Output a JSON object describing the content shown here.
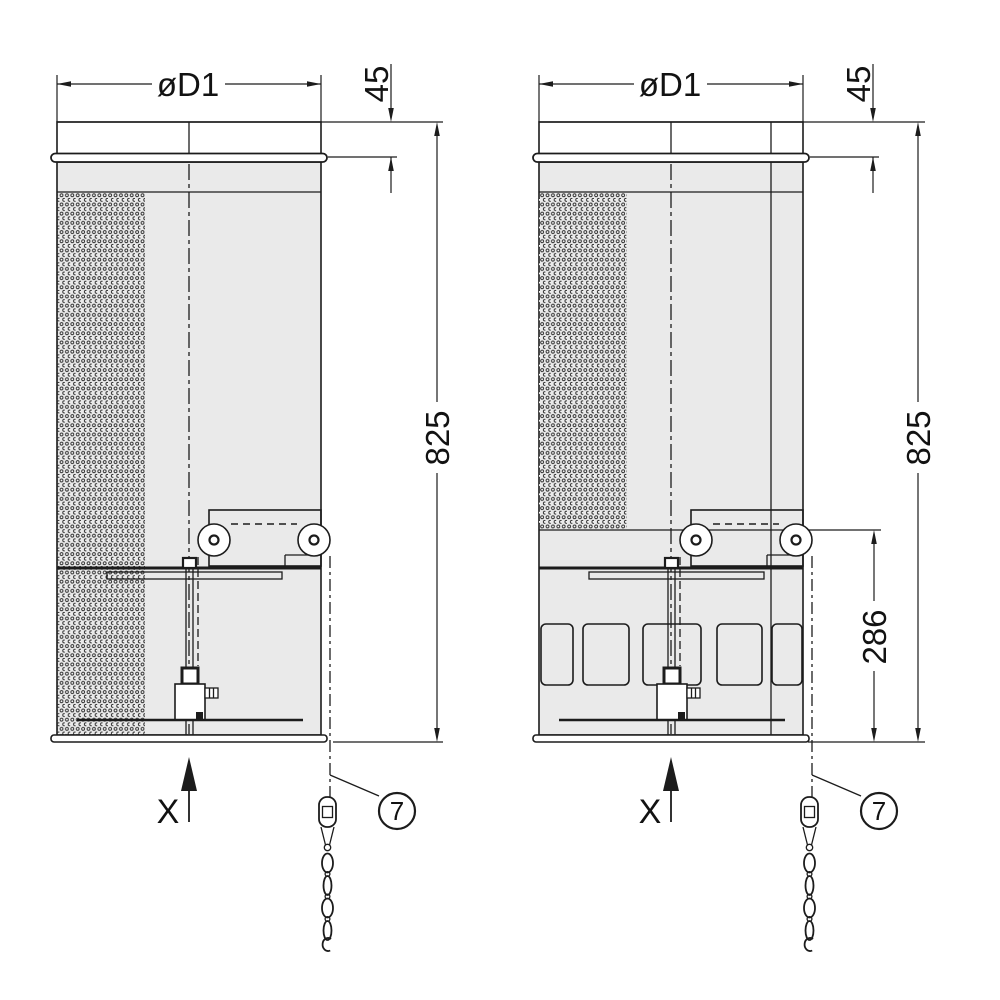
{
  "drawing": {
    "kind": "technical dimension drawing, two silencer/damper views",
    "colors": {
      "background": "#ffffff",
      "line": "#1c1c1c",
      "body_fill": "#eaeaea"
    },
    "views": {
      "left": {
        "diameter_label": "øD1",
        "collar_height_dim": "45",
        "overall_height_dim": "825",
        "view_direction_label": "X",
        "chain_callout": "7"
      },
      "right": {
        "diameter_label": "øD1",
        "collar_height_dim": "45",
        "overall_height_dim": "825",
        "damper_section_dim": "286",
        "view_direction_label": "X",
        "chain_callout": "7"
      }
    }
  }
}
